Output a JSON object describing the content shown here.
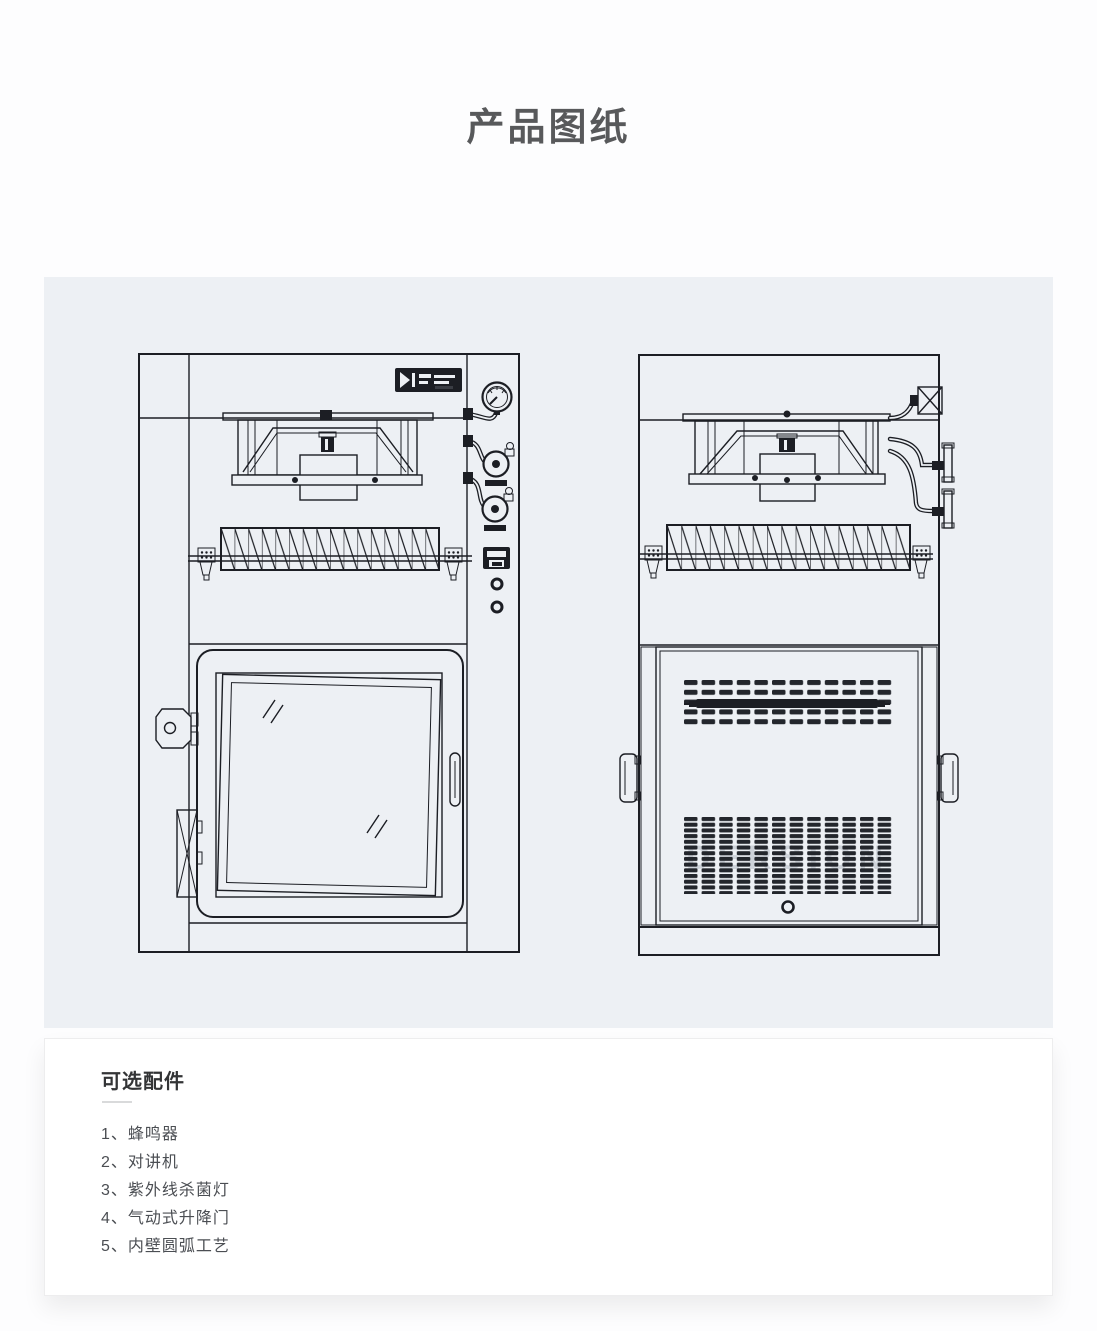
{
  "page": {
    "title": "产品图纸"
  },
  "drawings": {
    "panel_bg_color": "#edf0f4",
    "line_color": "#1c1e24",
    "watermark": "DERSION",
    "left_view": "pass-box front view with fan unit, pressure gauge, valves, switch, HEPA filter and glass door",
    "right_view": "pass-box rear view with fan unit, piping, HEPA filter, vented back panel and side handles"
  },
  "accessories": {
    "heading": "可选配件",
    "items": [
      "1、蜂鸣器",
      "2、对讲机",
      "3、紫外线杀菌灯",
      "4、气动式升降门",
      "5、内壁圆弧工艺"
    ]
  },
  "colors": {
    "title_text": "#58595b",
    "heading_text": "#333436",
    "body_text": "#4b4e53",
    "panel_bg": "#edf0f4",
    "card_bg": "#ffffff"
  }
}
